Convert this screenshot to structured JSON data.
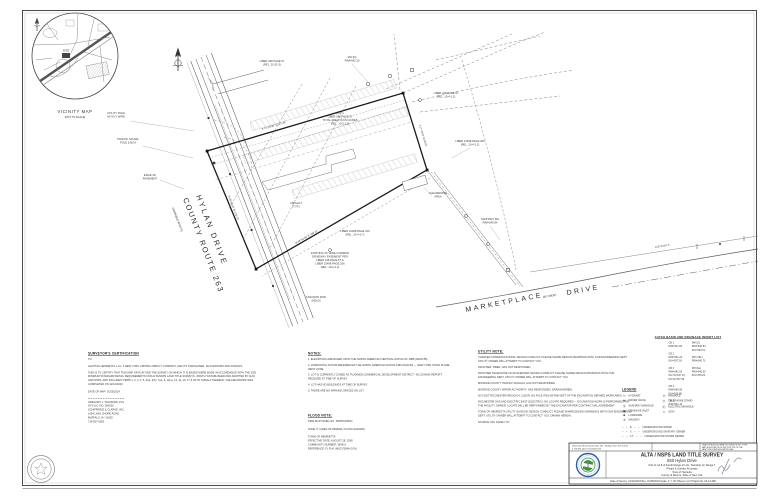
{
  "colors": {
    "logo_green": "#3f9146",
    "logo_blue": "#2b5ea7",
    "ink": "#2e2e2e"
  },
  "vicinity": {
    "title": "VICINITY MAP",
    "subtitle": "(NOT TO SCALE)",
    "site_label": "SITE"
  },
  "roads": {
    "hylan_name": "HYLAN DRIVE",
    "hylan_route": "COUNTY ROUTE 263",
    "hylan_width": "(VARIABLE WIDTH)",
    "marketplace_name": "MARKETPLACE",
    "marketplace_width": "(60' WIDE)",
    "marketplace_suffix": "DRIVE"
  },
  "plat": {
    "bearings": {
      "top": "S 72°10'30\" E   527.45'",
      "left": "S 19°29'10\" W   126.73'",
      "right": "S 17°20'50\" W   80.65'",
      "bottom": "N 59°52'40\" E   198.11'",
      "row_line": "N 82°33'50\" E"
    },
    "annotations": {
      "a1": {
        "text": "LIBER 348 PAGE 57\n(REL. 10-21-3)"
      },
      "a2": {
        "text": "MH (D)\nRIM=542.10"
      },
      "a3": {
        "text": "LIBER 10498 PAGE 206\n(REL. 10-4-1.2)"
      },
      "a4": {
        "text": "LOT 1\nLIBER 348 PAGE 57\nTOTAL AREA ±3.672 ACRES\n(REL. 10-2-1.2)"
      },
      "a5": {
        "text": "LIBER 10498 PAGE 310\n(REL. 10-4-1-7)"
      },
      "a6": {
        "text": "CLEARWATER\nAREA"
      },
      "a7": {
        "text": "EDGE OF\nPAVEMENT"
      },
      "a8": {
        "text": "TRAFFIC SIGNAL\nPOLE & BOX"
      },
      "a9": {
        "text": "UTILITY POLE\nW/ GUY WIRE"
      },
      "a10": {
        "text": "EXISTING 20' WIDE COMMON\nDRIVEWAY EASEMENT PER\nLIBER 348 PAGE 57 &\nLIBER 10498 PAGE 206\n(REL. 10-2-1.2)"
      },
      "a11": {
        "text": "ASPHALT\n(TYP.)"
      },
      "a12": {
        "text": "SANITARY MH\nRIM=540.84"
      },
      "a13": {
        "text": "LIBER 348 PAGE 57\n(REL. 10-4-1.2)"
      },
      "a14": {
        "text": "FND IRON ROD\n(HELD)"
      }
    }
  },
  "certification": {
    "heading": "SURVEYOR'S CERTIFICATION",
    "to_label": "TO:",
    "parties": "GHATTAS HENRIETTA, LLC, A NEW YORK LIMITED LIABILITY COMPANY, AND ITS PURCHASER, SUCCESSORS AND ASSIGNS:",
    "body": "THIS IS TO CERTIFY THAT THIS MAP OR PLAT AND THE SURVEY ON WHICH IT IS BASED WERE MADE IN ACCORDANCE WITH THE 2021 MINIMUM STANDARD DETAIL REQUIREMENTS FOR ALTA/NSPS LAND TITLE SURVEYS, JOINTLY ESTABLISHED AND ADOPTED BY ALTA AND NSPS, AND INCLUDES ITEMS 1, 2, 3, 4, 5, 6(a), 6(b), 7(a), 8, 11(a), 13, 14, 16, 17 & 18 OF TABLE A THEREOF. THE FIELDWORK WAS COMPLETED ON 12/12/2023.",
    "date_line": "DATE OF MAP: 01/25/2024",
    "signature": "GREGORY J. SCHIFFER, PLS\nNYS LIC. NO. 050635\nSCHIFFERLE & CLARKE, INC.\n1654 LAKE SHORE ROAD\nBUFFALO, NY 14225\n716-827-6500"
  },
  "notes": {
    "heading": "NOTES:",
    "items": [
      "1.  ELEVATIONS ARE BASED UPON THE NORTH AMERICAN VERTICAL DATUM OF 1988 (NAVD 88).",
      "2.  HORIZONTAL DATUM REFERENCES THE NORTH AMERICAN DATUM 1983 (NAD 83) — NEW YORK STATE PLANE WEST ZONE.",
      "3.  LOT IS CURRENTLY ZONED AS 'PLANNED COMMERCIAL DEVELOPMENT DISTRICT'. NO ZONING REPORT RECEIVED AT TIME OF SURVEY.",
      "4.  LOT HAS NO BUILDINGS AT TIME OF SURVEY.",
      "5.  THERE ARE NO PARKING SPACES ON LOT."
    ]
  },
  "flood": {
    "heading": "FLOOD NOTE:",
    "lines": "FIRM MAP PANEL NO. 36055C0354G\n\nZONE 'X'    (AREA OF MINIMAL FLOOD HAZARD)\n\nTOWN OF HENRIETTA\nEFFECTIVE DATE: AUGUST 28, 2008\nCOMMUNITY NUMBER: 360421\nREFERENCE: F.I.R.M. (MSC.FEMA.GOV)"
  },
  "utility": {
    "heading": "UTILITY NOTE:",
    "paragraphs": [
      "CHARTER COMMUNICATIONS: DESIGN CONFLICT, PLEASE SHARE DESIGN DRAWINGS WITH OUR ENGINEERING DEPT. UTILITY OWNER WILL ATTEMPT TO CONTACT YOU.",
      "FRONTIER: FIBER, HAS NOT RESPONDED.",
      "FRONTIER TELEPHONE OF ROCHESTER: DESIGN CONFLICT, PLEASE SHARE DESIGN DRAWINGS WITH OUR ENGINEERING DEPT. UTILITY OWNER WILL ATTEMPT TO CONTACT YOU.",
      "MONROE COUNTY TRAFFIC SIGNALS: HAS NOT RESPONDED.",
      "MONROE COUNTY WATER AUTHORITY: HAS RESPONDED, DRAWN HEREIN.",
      "NYS DOT ROCHESTER REGION 4: CLEAR, NO FACILITIES WITHIN 50FT OF THE EXCAVATION DEFINED WORK AREA.",
      "ROCHESTER GAS AND ELECTRIC EAST (ELECTRIC): NO LOCATE REQUIRED — EXCAVATION WORK IS PERFORMED FOR THE FACILITY OWNER. LOCATE WILL BE PERFORMED BY THE EXCAVATOR PER CONTRACTUAL AGREEMENT.",
      "TOWN OF HENRIETTA UTILITY DIVISION: DESIGN CONFLICT, PLEASE SHARE DESIGN DRAWINGS WITH OUR ENGINEERING DEPT. UTILITY OWNER WILL ATTEMPT TO CONTACT YOU. DRAWN HEREIN.",
      "SOURCE: DIG SAFELY NY"
    ]
  },
  "inverts": {
    "heading": "CATCH BASIN AND DRAINAGE INVERT LIST",
    "col1": "CB 1\nRIM=541.82\n\nCB 2\nRIM=541.23\nINV=537.93\n\nCB 3\nRIM=541.05\nINV W=537.15\nINV E=537.08\n\nCB 4\nRIM=540.96\nINV=536.88\n\nCB 5\nRIM=541.10",
    "col2": "MH (S)\nRIM=540.84\nINV=532.61\n\nMH (TEL)\nRIM=540.71\n\nMH (EL)\nRIM=540.55\nINV=535.20"
  },
  "legend": {
    "heading": "LEGEND",
    "left": [
      {
        "sym": "▭",
        "label": "HYDRANT"
      },
      {
        "sym": "⋈",
        "label": "WATER VALVE"
      },
      {
        "sym": "Ⓢ",
        "label": "SANITARY MANHOLE"
      },
      {
        "sym": "▣",
        "label": "DRAINAGE INLET"
      },
      {
        "sym": "■",
        "label": "LUMINAIRE"
      },
      {
        "sym": "✛",
        "label": "MAILBOX"
      }
    ],
    "right": [
      {
        "sym": "◎",
        "label": "MANHOLE"
      },
      {
        "sym": "Ⓣ",
        "label": "TELEPHONE STAND"
      },
      {
        "sym": "Ⓔ",
        "label": "ELECTRIC MANHOLE"
      },
      {
        "sym": "▽",
        "label": "SIGN"
      }
    ],
    "lines": [
      {
        "dash": "—  —  W  —  —",
        "label": "UNDERGROUND WATER"
      },
      {
        "dash": "—  —  S  —  —",
        "label": "UNDERGROUND SANITARY SEWER"
      },
      {
        "dash": "—  —  ST  —  —",
        "label": "UNDERGROUND STORM SEWER"
      }
    ]
  },
  "title_block": {
    "address": "1654 Lake Shore Road, Suite 200  ·  Buffalo, New York 14219",
    "phone": "p 716.824.1470    f 716.824.1473",
    "law_note_1": "UNAUTHORIZED ALTERATION OR ADDITION TO THIS",
    "law_note_2": "MAP IS A VIOLATION OF SECTION 7209 OF THE",
    "law_note_3": "NEW YORK STATE EDUCATION LAW.",
    "title": "ALTA / NSPS LAND TITLE SURVEY",
    "subtitle": "840 Hylan Drive",
    "desc1": "Part of Lot 8 of Fourth Range of Lots, Township 12, Range 7",
    "desc2": "Phelps & Gorham Purchase",
    "desc3": "Town of Henrietta",
    "desc4": "County of Monroe, State of New York",
    "info": "Date of Survey: 12/12/2023     Rev. 01/25/2024     Scale: 1\" = 30'     Sheet 1 of 2     Project No. 23-2-1308"
  }
}
